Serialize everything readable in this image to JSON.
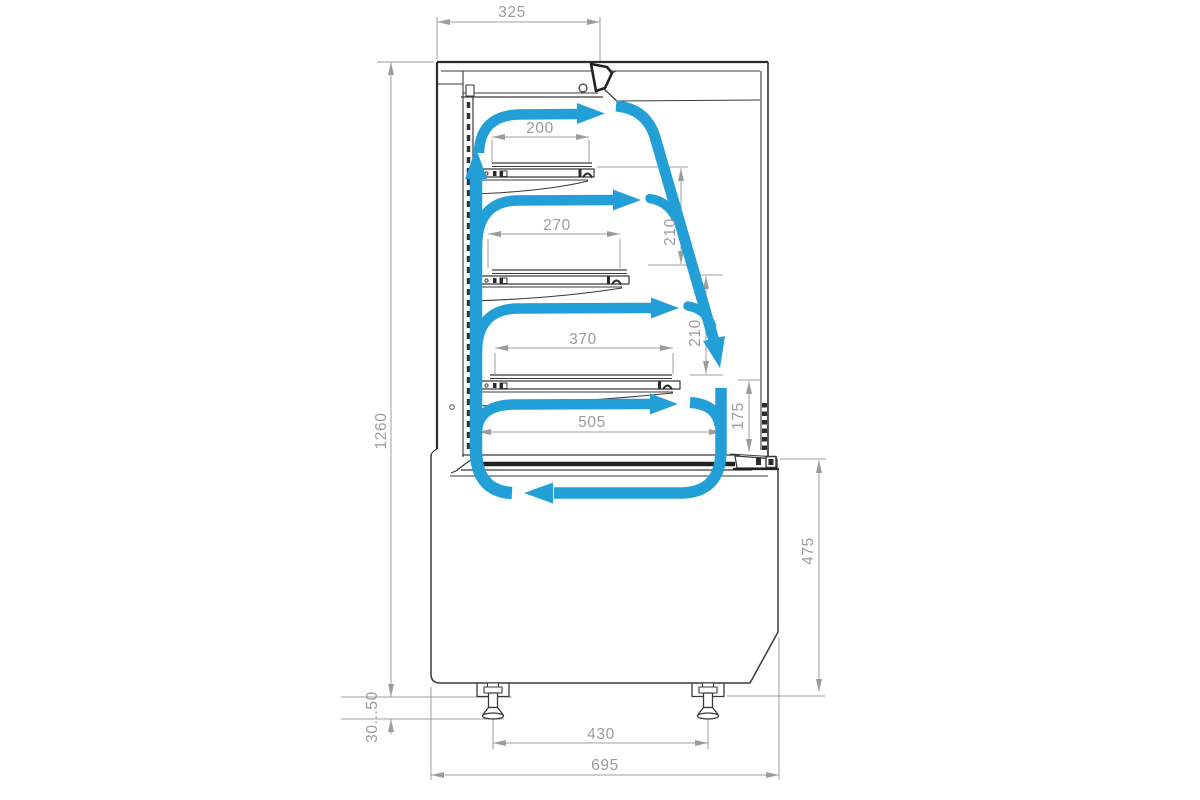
{
  "meta": {
    "description": "Technical side cross-section drawing of a refrigerated confectionery display case with blue air-flow circulation arrows and millimetre dimensions"
  },
  "colors": {
    "airflow_blue": "#239FD8",
    "dimension_gray": "#9C9C9C",
    "outline_dark": "#3A3A3A"
  },
  "dims": {
    "top_depth": "325",
    "shelf1_depth": "200",
    "shelf2_depth": "270",
    "shelf3_depth": "370",
    "deck_depth": "505",
    "gap_shelf1_shelf2": "210",
    "gap_shelf2_shelf3": "210",
    "gap_shelf3_deck": "175",
    "overall_height": "1260",
    "base_height": "475",
    "leg_adjust_range": "30...50",
    "leg_spacing": "430",
    "overall_depth": "695"
  }
}
